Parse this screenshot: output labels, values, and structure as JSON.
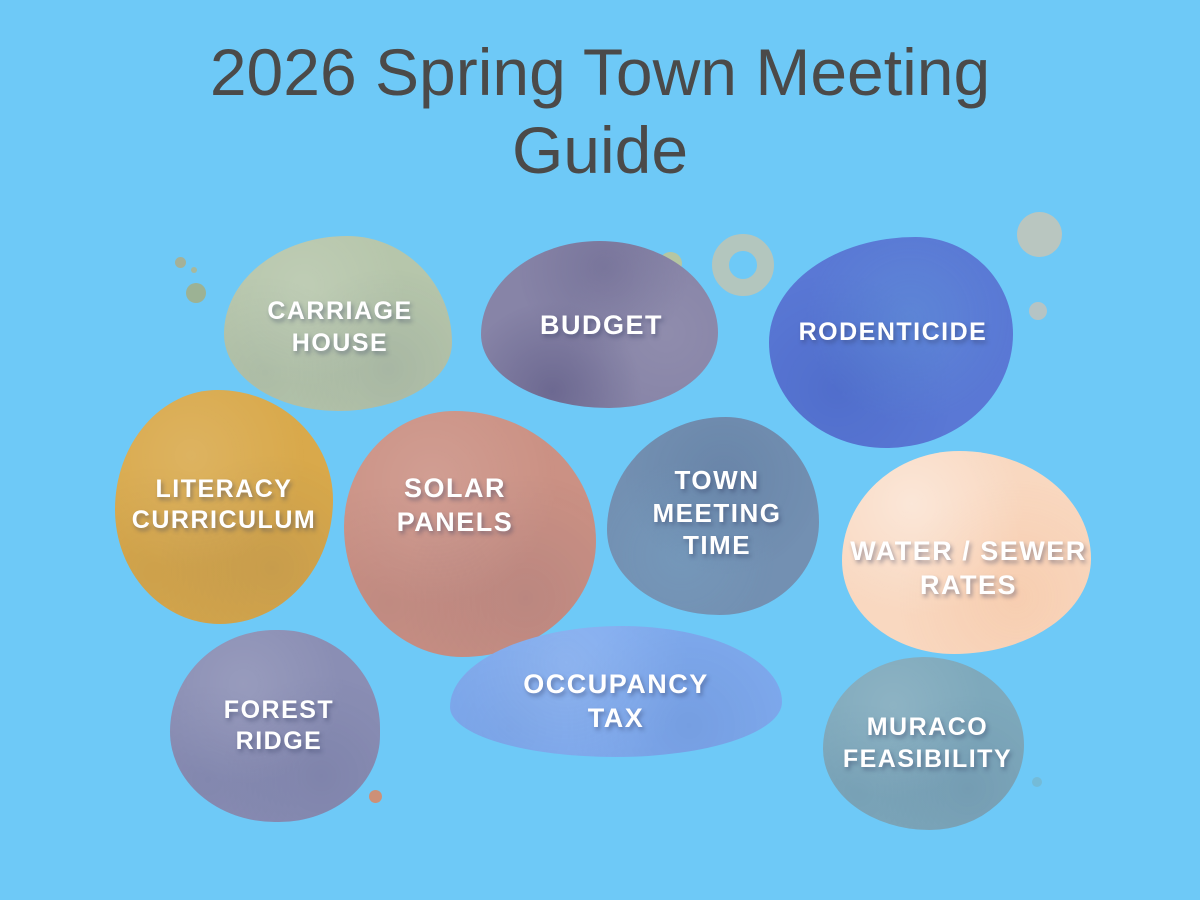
{
  "poster": {
    "title_line1": "2026 Spring Town Meeting",
    "title_line2": "Guide",
    "title_color": "#4b4a49",
    "background_color": "#6ec9f7",
    "label_text_color": "#ffffff"
  },
  "topics": [
    {
      "name": "carriage-house",
      "lines": [
        "CARRIAGE",
        "HOUSE"
      ],
      "color": "#b6c6ab"
    },
    {
      "name": "budget",
      "lines": [
        "BUDGET"
      ],
      "color": "#8784a7"
    },
    {
      "name": "rodenticide",
      "lines": [
        "RODENTICIDE"
      ],
      "color": "#5a78d5"
    },
    {
      "name": "literacy-curriculum",
      "lines": [
        "LITERACY",
        "CURRICULUM"
      ],
      "color": "#d9a94b"
    },
    {
      "name": "solar-panels",
      "lines": [
        "SOLAR",
        "PANELS"
      ],
      "color": "#cb9184"
    },
    {
      "name": "town-meeting-time",
      "lines": [
        "TOWN",
        "MEETING",
        "TIME"
      ],
      "color": "#7390b2"
    },
    {
      "name": "water-sewer-rates",
      "lines": [
        "WATER / SEWER",
        "RATES"
      ],
      "color": "#f9d8c0"
    },
    {
      "name": "forest-ridge",
      "lines": [
        "FOREST",
        "RIDGE"
      ],
      "color": "#8a8eb4"
    },
    {
      "name": "occupancy-tax",
      "lines": [
        "OCCUPANCY",
        "TAX"
      ],
      "color": "#7fabef"
    },
    {
      "name": "muraco-feasibility",
      "lines": [
        "MURACO",
        "FEASIBILITY"
      ],
      "color": "#7ea9bc"
    }
  ],
  "decorations": [
    {
      "name": "sage-dot-small",
      "color": "#a4b198"
    },
    {
      "name": "sage-dot-tiny",
      "color": "#a6b89e"
    },
    {
      "name": "sage-dot-medium",
      "color": "#9cb294"
    },
    {
      "name": "green-dot-near-budget",
      "color": "#b5c6a2"
    },
    {
      "name": "donut-ring",
      "color": "#b8c5b8"
    },
    {
      "name": "pale-circle-large",
      "color": "#b9c6c0"
    },
    {
      "name": "pale-circle-small",
      "color": "#b5c4c5"
    },
    {
      "name": "salmon-dot",
      "color": "#cd9077"
    },
    {
      "name": "teal-dot",
      "color": "#74bbd8"
    }
  ]
}
